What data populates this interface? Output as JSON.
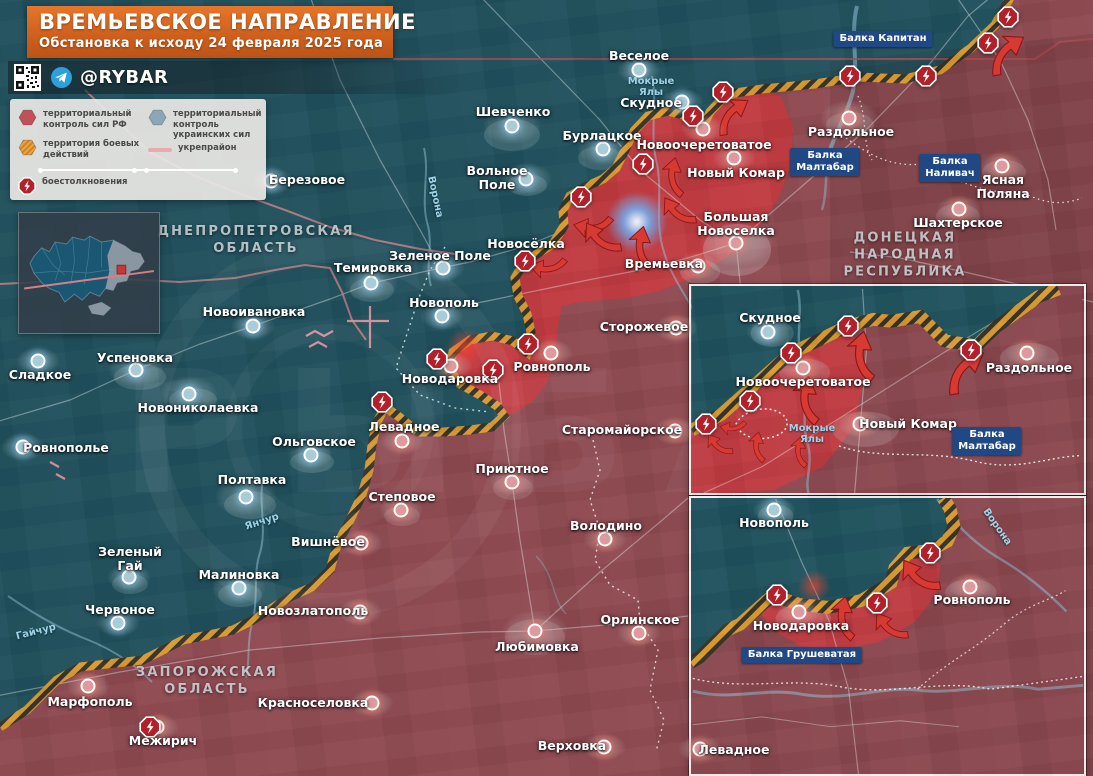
{
  "banner": {
    "title": "ВРЕМЬЕВСКОЕ НАПРАВЛЕНИЕ",
    "subtitle": "Обстановка к исходу 24 февраля 2025 года"
  },
  "source_bar": {
    "handle": "@RYBAR"
  },
  "legend": {
    "items": [
      {
        "icon": "hex-rf",
        "label": "территориальный контроль сил РФ"
      },
      {
        "icon": "hex-ua",
        "label": "территориальный контроль украинских сил"
      },
      {
        "icon": "hex-battle",
        "label": "территория боевых действий"
      },
      {
        "icon": "line-ukrep",
        "label": "укрепрайон"
      },
      {
        "icon": "hex-clash",
        "label": "боестолкновения"
      }
    ]
  },
  "colors": {
    "ua_zone": "#1e515c",
    "ru_zone": "#8e4950",
    "active_zone": "#c43a3f",
    "hatch_orange": "#d89a2f",
    "accent_banner": "#d2691e",
    "balka_box": "#1f4884"
  },
  "regions": [
    {
      "lines": [
        "ДНЕПРОПЕТРОВСКАЯ",
        "ОБЛАСТЬ"
      ],
      "x": 256,
      "y": 241
    },
    {
      "lines": [
        "ДОНЕЦКАЯ",
        "НАРОДНАЯ",
        "РЕСПУБЛИКА"
      ],
      "x": 905,
      "y": 256
    },
    {
      "lines": [
        "ЗАПОРОЖСКАЯ",
        "ОБЛАСТЬ"
      ],
      "x": 207,
      "y": 682
    }
  ],
  "settlements": [
    {
      "n": "Веселое",
      "dot": [
        639,
        70
      ],
      "lab": [
        639,
        56
      ],
      "side": "ua"
    },
    {
      "n": "Скудное",
      "dot": [
        682,
        102
      ],
      "lab": [
        651,
        103
      ],
      "side": "ua"
    },
    {
      "n": "Шевченко",
      "dot": [
        512,
        126
      ],
      "lab": [
        513,
        112
      ],
      "side": "ua",
      "blob": 56
    },
    {
      "n": "Бурлацкое",
      "dot": [
        603,
        149
      ],
      "lab": [
        602,
        136
      ],
      "side": "ua",
      "blob": 50
    },
    {
      "n": "Вольное Поле",
      "lines": [
        "Вольное",
        "Поле"
      ],
      "dot": [
        526,
        179
      ],
      "lab": [
        497,
        178
      ],
      "side": "ua",
      "blob": 50
    },
    {
      "n": "Березовое",
      "dot": [
        271,
        181
      ],
      "lab": [
        307,
        180
      ],
      "side": "ua"
    },
    {
      "n": "Новосёлка",
      "lab": [
        526,
        244
      ],
      "side": "ua"
    },
    {
      "n": "Зеленое Поле",
      "dot": [
        443,
        268
      ],
      "lab": [
        440,
        256
      ],
      "side": "ua"
    },
    {
      "n": "Темировка",
      "dot": [
        371,
        283
      ],
      "lab": [
        373,
        268
      ],
      "side": "ua",
      "blob": 52
    },
    {
      "n": "Новополь",
      "dot": [
        442,
        316
      ],
      "lab": [
        444,
        303
      ],
      "side": "ua"
    },
    {
      "n": "Новоивановка",
      "dot": [
        253,
        326
      ],
      "lab": [
        254,
        312
      ],
      "side": "ua"
    },
    {
      "n": "Успеновка",
      "dot": [
        136,
        370
      ],
      "lab": [
        135,
        358
      ],
      "side": "ua",
      "blob": 54
    },
    {
      "n": "Сладкое",
      "dot": [
        38,
        361
      ],
      "lab": [
        40,
        375
      ],
      "side": "ua"
    },
    {
      "n": "Новониколаевка",
      "dot": [
        189,
        394
      ],
      "lab": [
        198,
        408
      ],
      "side": "ua",
      "blob": 56
    },
    {
      "n": "Ровнополье",
      "dot": [
        23,
        447
      ],
      "lab": [
        66,
        448
      ],
      "side": "ua"
    },
    {
      "n": "Ольговское",
      "dot": [
        311,
        455
      ],
      "lab": [
        314,
        442
      ],
      "side": "ua"
    },
    {
      "n": "Полтавка",
      "dot": [
        246,
        497
      ],
      "lab": [
        252,
        480
      ],
      "side": "ua",
      "blob": 60
    },
    {
      "n": "Зеленый Гай",
      "lines": [
        "Зеленый",
        "Гай"
      ],
      "dot": [
        129,
        577
      ],
      "lab": [
        130,
        559
      ],
      "side": "ua"
    },
    {
      "n": "Малиновка",
      "dot": [
        239,
        588
      ],
      "lab": [
        239,
        575
      ],
      "side": "ua",
      "blob": 52
    },
    {
      "n": "Червоное",
      "dot": [
        118,
        623
      ],
      "lab": [
        120,
        610
      ],
      "side": "ua"
    },
    {
      "n": "Новоочеретоватое",
      "dot": [
        703,
        129
      ],
      "lab": [
        704,
        145
      ],
      "side": "ru"
    },
    {
      "n": "Новый Комар",
      "dot": [
        734,
        158
      ],
      "lab": [
        736,
        173
      ],
      "side": "ru"
    },
    {
      "n": "Большая Новоселка",
      "lines": [
        "Большая",
        "Новоселка"
      ],
      "dot": [
        736,
        243
      ],
      "lab": [
        736,
        224
      ],
      "side": "ru",
      "blob": 72
    },
    {
      "n": "Раздольное",
      "dot": [
        849,
        118
      ],
      "lab": [
        851,
        132
      ],
      "side": "ru",
      "blob": 56
    },
    {
      "n": "Шахтерское",
      "dot": [
        959,
        209
      ],
      "lab": [
        958,
        223
      ],
      "side": "ru"
    },
    {
      "n": "Ясная Поляна",
      "lines": [
        "Ясная",
        "Поляна"
      ],
      "dot": [
        1002,
        166
      ],
      "lab": [
        1003,
        187
      ],
      "side": "ru"
    },
    {
      "n": "Времьевка",
      "dot": [
        698,
        266
      ],
      "lab": [
        664,
        264
      ],
      "side": "ru"
    },
    {
      "n": "Сторожевое",
      "dot": [
        676,
        328
      ],
      "lab": [
        644,
        327
      ],
      "side": "ru"
    },
    {
      "n": "Ровнополь",
      "dot": [
        551,
        353
      ],
      "lab": [
        552,
        367
      ],
      "side": "ru"
    },
    {
      "n": "Новодаровка",
      "dot": [
        451,
        366
      ],
      "lab": [
        450,
        379
      ],
      "side": "ru"
    },
    {
      "n": "Старомайорское",
      "dot": [
        675,
        431
      ],
      "lab": [
        622,
        430
      ],
      "side": "ru"
    },
    {
      "n": "Левадное",
      "dot": [
        402,
        441
      ],
      "lab": [
        404,
        427
      ],
      "side": "ru"
    },
    {
      "n": "Приютное",
      "dot": [
        512,
        482
      ],
      "lab": [
        512,
        469
      ],
      "side": "ru"
    },
    {
      "n": "Степовое",
      "dot": [
        401,
        510
      ],
      "lab": [
        402,
        497
      ],
      "side": "ru"
    },
    {
      "n": "Вишнёвое",
      "dot": [
        361,
        543
      ],
      "lab": [
        328,
        542
      ],
      "side": "ru"
    },
    {
      "n": "Володино",
      "dot": [
        605,
        539
      ],
      "lab": [
        606,
        526
      ],
      "side": "ru"
    },
    {
      "n": "Новозлатополь",
      "dot": [
        360,
        612
      ],
      "lab": [
        313,
        611
      ],
      "side": "ru"
    },
    {
      "n": "Любимовка",
      "dot": [
        535,
        631
      ],
      "lab": [
        537,
        647
      ],
      "side": "ru",
      "blob": 64
    },
    {
      "n": "Орлинское",
      "dot": [
        639,
        633
      ],
      "lab": [
        640,
        620
      ],
      "side": "ru"
    },
    {
      "n": "Верховка",
      "dot": [
        604,
        747
      ],
      "lab": [
        572,
        746
      ],
      "side": "ru"
    },
    {
      "n": "Марфополь",
      "dot": [
        88,
        686
      ],
      "lab": [
        90,
        702
      ],
      "side": "ru"
    },
    {
      "n": "Межирич",
      "dot": [
        157,
        727
      ],
      "lab": [
        163,
        741
      ],
      "side": "ru"
    },
    {
      "n": "Красноселовка",
      "dot": [
        372,
        703
      ],
      "lab": [
        313,
        703
      ],
      "side": "ru"
    },
    {
      "n": "Скудное",
      "dot": [
        768,
        332
      ],
      "lab": [
        770,
        318
      ],
      "side": "ua"
    },
    {
      "n": "Новоочеретоватое",
      "dot": [
        803,
        368
      ],
      "lab": [
        803,
        382
      ],
      "side": "ru"
    },
    {
      "n": "Новый Комар",
      "dot": [
        860,
        424
      ],
      "lab": [
        908,
        424
      ],
      "side": "ru"
    },
    {
      "n": "Раздольное",
      "dot": [
        1027,
        353
      ],
      "lab": [
        1029,
        368
      ],
      "side": "ru"
    },
    {
      "n": "Новополь",
      "dot": [
        774,
        510
      ],
      "lab": [
        774,
        523
      ],
      "side": "ua"
    },
    {
      "n": "Ровнополь",
      "dot": [
        970,
        587
      ],
      "lab": [
        972,
        600
      ],
      "side": "ru"
    },
    {
      "n": "Новодаровка",
      "dot": [
        799,
        612
      ],
      "lab": [
        801,
        626
      ],
      "side": "ru"
    },
    {
      "n": "Левадное",
      "dot": [
        700,
        749
      ],
      "lab": [
        734,
        750
      ],
      "side": "ru"
    }
  ],
  "clash_icons": [
    [
      581,
      197
    ],
    [
      643,
      164
    ],
    [
      693,
      116
    ],
    [
      723,
      92
    ],
    [
      850,
      76
    ],
    [
      926,
      76
    ],
    [
      988,
      43
    ],
    [
      1008,
      17
    ],
    [
      525,
      261
    ],
    [
      528,
      344
    ],
    [
      493,
      370
    ],
    [
      437,
      359
    ],
    [
      382,
      402
    ],
    [
      150,
      727
    ],
    [
      848,
      326
    ],
    [
      791,
      353
    ],
    [
      750,
      401
    ],
    [
      706,
      424
    ],
    [
      971,
      350
    ],
    [
      930,
      553
    ],
    [
      777,
      595
    ],
    [
      877,
      603
    ]
  ],
  "arrows": [
    {
      "x": 548,
      "y": 268,
      "r": 200,
      "s": 0.85
    },
    {
      "x": 593,
      "y": 227,
      "r": 200,
      "s": 0.9
    },
    {
      "x": 600,
      "y": 240,
      "r": 245,
      "s": 1.0
    },
    {
      "x": 641,
      "y": 248,
      "r": 290,
      "s": 1.0
    },
    {
      "x": 677,
      "y": 213,
      "r": 245,
      "s": 0.9
    },
    {
      "x": 673,
      "y": 177,
      "r": 290,
      "s": 0.9
    },
    {
      "x": 731,
      "y": 114,
      "r": 335,
      "s": 1.0
    },
    {
      "x": 1005,
      "y": 52,
      "r": 335,
      "s": 1.1
    },
    {
      "x": 806,
      "y": 400,
      "r": 290,
      "s": 1.1
    },
    {
      "x": 861,
      "y": 356,
      "r": 290,
      "s": 1.15
    },
    {
      "x": 963,
      "y": 369,
      "r": 335,
      "s": 1.2
    },
    {
      "x": 718,
      "y": 446,
      "r": 245,
      "s": 0.7
    },
    {
      "x": 757,
      "y": 447,
      "r": 290,
      "s": 0.7
    },
    {
      "x": 799,
      "y": 452,
      "r": 290,
      "s": 0.7
    },
    {
      "x": 733,
      "y": 428,
      "r": 200,
      "s": 0.6
    },
    {
      "x": 918,
      "y": 578,
      "r": 245,
      "s": 1.05
    },
    {
      "x": 843,
      "y": 618,
      "r": 290,
      "s": 1.0
    },
    {
      "x": 889,
      "y": 628,
      "r": 245,
      "s": 0.9
    }
  ],
  "glows": [
    {
      "x": 637,
      "y": 222,
      "r": 26,
      "c": "rgba(110,175,245,0.85)",
      "core": true
    },
    {
      "x": 465,
      "y": 347,
      "r": 17,
      "c": "rgba(255,70,48,0.65)"
    },
    {
      "x": 803,
      "y": 368,
      "r": 13,
      "c": "rgba(255,70,48,0.6)"
    },
    {
      "x": 814,
      "y": 586,
      "r": 15,
      "c": "rgba(255,70,48,0.65)"
    }
  ],
  "balka_labels": [
    {
      "lines": [
        "Балка Капитан"
      ],
      "x": 883,
      "y": 39
    },
    {
      "lines": [
        "Балка",
        "Малтабар"
      ],
      "x": 825,
      "y": 162
    },
    {
      "lines": [
        "Балка",
        "Наливач"
      ],
      "x": 950,
      "y": 168
    },
    {
      "lines": [
        "Балка",
        "Малтабар"
      ],
      "x": 987,
      "y": 441
    },
    {
      "lines": [
        "Балка Грушеватая"
      ],
      "x": 802,
      "y": 655
    }
  ],
  "river_labels": [
    {
      "lines": [
        "Мокрые",
        "Ялы"
      ],
      "x": 651,
      "y": 87,
      "rot": 0
    },
    {
      "lines": [
        "Ворона"
      ],
      "x": 435,
      "y": 197,
      "rot": 78
    },
    {
      "lines": [
        "Янчур"
      ],
      "x": 262,
      "y": 522,
      "rot": -18
    },
    {
      "lines": [
        "Гайчур"
      ],
      "x": 36,
      "y": 632,
      "rot": -14
    },
    {
      "lines": [
        "Мокрые",
        "Ялы"
      ],
      "x": 812,
      "y": 434,
      "rot": 0
    },
    {
      "lines": [
        "Ворона"
      ],
      "x": 997,
      "y": 527,
      "rot": 55
    }
  ]
}
